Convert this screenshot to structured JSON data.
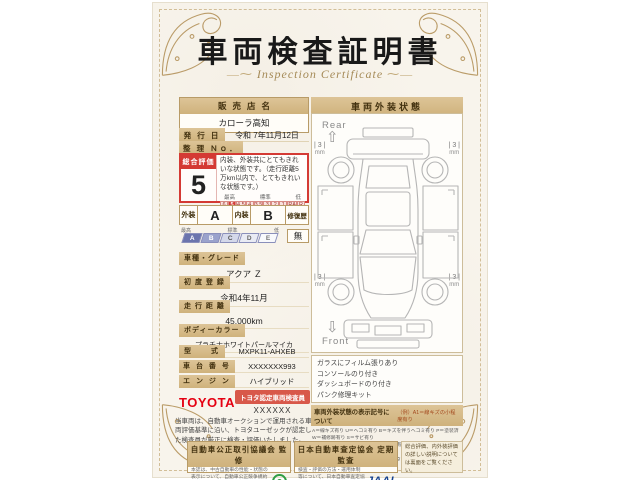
{
  "title": "車両検査証明書",
  "subtitle": "Inspection Certificate",
  "dealer": {
    "label": "販売店名",
    "name": "カローラ高知"
  },
  "issue": {
    "label": "発 行 日",
    "value": "令和 7年11月12日"
  },
  "ref_no": {
    "label": "整 理 Ｎｏ．",
    "value": ""
  },
  "evaluation": {
    "label": "総合評価",
    "score": "5",
    "description": "内装、外装共にとてもきれいな状態です。（走行距離5万km以内で、とてもきれいな状態です。）",
    "scale_high": "最高",
    "scale_mid": "標準",
    "scale_low": "低",
    "scale": [
      "6",
      "5",
      "4.5",
      "4",
      "3.5",
      "3",
      "2",
      "1",
      "RA",
      "R"
    ]
  },
  "grades": {
    "exterior_label": "外装",
    "exterior": "A",
    "interior_label": "内装",
    "interior": "B",
    "repair_label": "修復歴",
    "repair": "無",
    "scale_high": "最高",
    "scale_mid": "標準",
    "scale_low": "低",
    "scale": [
      "A",
      "B",
      "C",
      "D",
      "E"
    ]
  },
  "specs": [
    {
      "label": "車種・グレード",
      "value": "アクア Ｚ"
    },
    {
      "label": "初 度 登 録",
      "value": "令和4年11月"
    },
    {
      "label": "走 行 距 離",
      "value": "45,000km"
    },
    {
      "label": "ボディーカラー",
      "value": "プラチナホワイトパールマイカ"
    },
    {
      "label": "型　　式",
      "value": "MXPK11-AHXEB"
    },
    {
      "label": "車 台 番 号",
      "value": "XXXXXXX993"
    },
    {
      "label": "エ ン ジ ン",
      "value": "ハイブリッド"
    }
  ],
  "inspector": {
    "brand": "TOYOTA",
    "badge": "トヨタ認定車両検査員",
    "id": "XXXXXX"
  },
  "disclaimer": "当車両は、自動車オークションで運用される車両評価基準に沿い、トヨタユーゼックが認定した検査員が厳正に検査・評価いたしました。",
  "exterior_panel": {
    "title": "車両外装状態",
    "rear_label": "Rear",
    "front_label": "Front",
    "tire_value": "3",
    "tire_unit": "mm",
    "notes": [
      "ガラスにフィルム張りあり",
      "コンソールのり付き",
      "ダッシュボードのり付き",
      "パンク修理キット"
    ],
    "legend_title": "車両外装状態の表示記号について",
    "legend_example": "（例）A1＝線キズの小程度有り",
    "legend_lines": [
      "A＝線キズ有り U＝ヘコミ有り B＝キズを伴うヘコミ有り P＝塗装済 W＝補修跡有り S＝サビ有り",
      "C＝腐食有り Y＝フロントガラスにヒビ有り X＝要交換（裏側に修理跡有り） XX＝交換済有り",
      "1＝小程度 2＝中程度 3＝大程度以上 ・タイヤ溝は数字（mm）で表示しています。"
    ]
  },
  "footer": {
    "fair_trade": {
      "title": "自動車公正取引協議会 監修",
      "text": "本誌は、中古自動車の性能・状態の表示について、自動車公正競争規約に基づき適正な表示を行っています。"
    },
    "jaai": {
      "title": "日本自動車査定協会 定期監査",
      "text": "検査・評価の方法・運用体制等について、日本自動車査定協会による監査を定期的に受けています。",
      "logo": "JAAI"
    },
    "backside_note": "総合評価、内外装評価の詳しい説明については裏面をご覧ください。"
  }
}
